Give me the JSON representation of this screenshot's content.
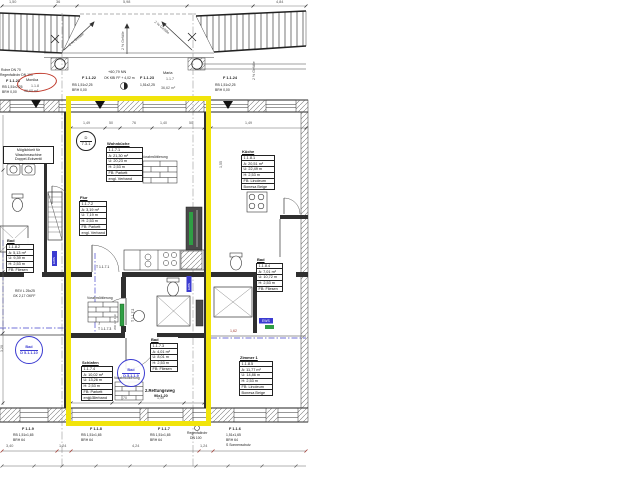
{
  "colors": {
    "highlight": "#f1e40b",
    "blue": "#3b3bd1",
    "red": "#c0392b",
    "green": "#2f9e44"
  },
  "top_dims": [
    "1,50",
    "36",
    "5,98",
    "4,84"
  ],
  "slopes": {
    "left": "2 % Gefälle",
    "mid": "2 % Gefälle",
    "right": "2 % Gefälle",
    "edge": "2 % Gefälle"
  },
  "header": {
    "note1": "Rohre DN 70",
    "note2": "Regenfallrohr DN 100",
    "level1": "+60,79 NN",
    "level2": "OK KBI FF + 4,02 m",
    "monika_name": "Monika",
    "monika_id": "1.1.8",
    "monika_area": "36,60 m²",
    "maria_name": "Maria",
    "maria_id": "1.1.7",
    "maria_area": "36,62 m²",
    "w21_id": "F 1.1.21",
    "w21_size": "RB  1,51x2,25",
    "w21_sill": "BRH 0,00",
    "w22_id": "F 1.1.22",
    "w22_size": "RB  1,51x2,25",
    "w22_sill": "BRH 0,00",
    "w23_id": "F 1.1.23",
    "w23_size": "1,51x2,25",
    "w24_id": "F 1.1.24",
    "w24_size": "RB  1,51x2,25",
    "w24_sill": "BRH 0,00"
  },
  "circles": {
    "d731_top": "D",
    "d731_bot": "7.3.1",
    "bad_left_top": "Bad",
    "bad_left_bot": "D 5.1.1.10",
    "bad_unit_top": "Bad",
    "bad_unit_bot": "D 5.1.1.9"
  },
  "rooms": {
    "wohnkueche": {
      "lines": [
        "Wohnküche",
        "1.1.7.1",
        "A:  21,30 m²",
        "U:  20,23 m",
        "H:  2,53 m",
        "FB:  Parkett",
        "engl. Verband"
      ]
    },
    "flur": {
      "lines": [
        "Flur",
        "1.1.7.2",
        "A:  3,19 m²",
        "U:  7,19 m",
        "H:  2,53 m",
        "FB:  Parkett",
        "engl. Verband"
      ]
    },
    "bad_unit": {
      "lines": [
        "Bad",
        "1.1.7.3",
        "A:  4,01 m²",
        "U:  8,01 m",
        "H:  2,53 m",
        "FB:  Fliesen"
      ]
    },
    "schlafen": {
      "lines": [
        "Schlafen",
        "1.1.7.4",
        "A:  10,02 m²",
        "U:  13,26 m",
        "H:  2,53 m",
        "FB:  Parkett",
        "engl. Verband"
      ]
    },
    "bad_links": {
      "lines": [
        "Bad",
        "1.1.8.2",
        "A:  5,13 m²",
        "U:  9,39 m",
        "H:  2,53 m",
        "FB:  Fliesen"
      ]
    },
    "kueche": {
      "lines": [
        "Küche",
        "1.1.8.1",
        "A:  20,51 m²",
        "U:  22,49 m",
        "H:  2,53 m",
        "FB:  Linoleum",
        "Bonesa Beige"
      ]
    },
    "bad_rechts": {
      "lines": [
        "Bad",
        "1.1.8.4",
        "A:  7,01 m²",
        "U:  10,72 m",
        "H:  2,53 m",
        "FB:  Fliesen"
      ]
    },
    "zimmer1": {
      "lines": [
        "Zimmer 1",
        "1.1.8.5",
        "A:  11,77 m²",
        "U:  14,86 m",
        "H:  2,53 m",
        "FB:  Linoleum",
        "Bonesa Beige"
      ]
    }
  },
  "doors": {
    "t1": "T 1.1.7.1",
    "t2": "T 1.1.7.2",
    "t3": "T 1.1.7.3"
  },
  "labels": {
    "vorab": "Vorabmöblierung",
    "wash1": "Möglichkeit für",
    "wash2": "Waschmaschine",
    "wash3": "Doppel-Eckventil",
    "rev1": "REV L 25x25",
    "rev2": "GK 2,17 OKFF",
    "ews": "EWS",
    "wd": "WD UP 119",
    "rescue1": "2.Rettungsweg",
    "rescue2": "90x1,20"
  },
  "interior_dims": {
    "wohn": [
      "1,49",
      "50",
      "76",
      "1,40",
      "50"
    ],
    "wohn_right": "1,49",
    "schlaf": [
      "1,40",
      "70",
      "1,40"
    ],
    "left_v": "3,20",
    "right_v": "1,55",
    "right_h": "1,62"
  },
  "bottom": {
    "b9_id": "F 1.1.9",
    "b9_size": "RB  1,51x1,65",
    "b9_sill": "BRH  64",
    "b8_id": "F 1.1.8",
    "b8_size": "RB  1,51x1,65",
    "b8_sill": "BRH  64",
    "b7_id": "F 1.1.7",
    "b7_size": "RB  1,51x1,65",
    "b7_sill": "BRH  64",
    "b6_id": "F 1.1.6",
    "b6_size": "1,51x1,65",
    "b6_sill": "BRH  64",
    "b6_extra": "S   Sonnenschutz",
    "drain1": "Regenfallrohr",
    "drain2": "DN 100",
    "dims": [
      "3,40",
      "1,24",
      "4,24",
      "1,24"
    ]
  }
}
